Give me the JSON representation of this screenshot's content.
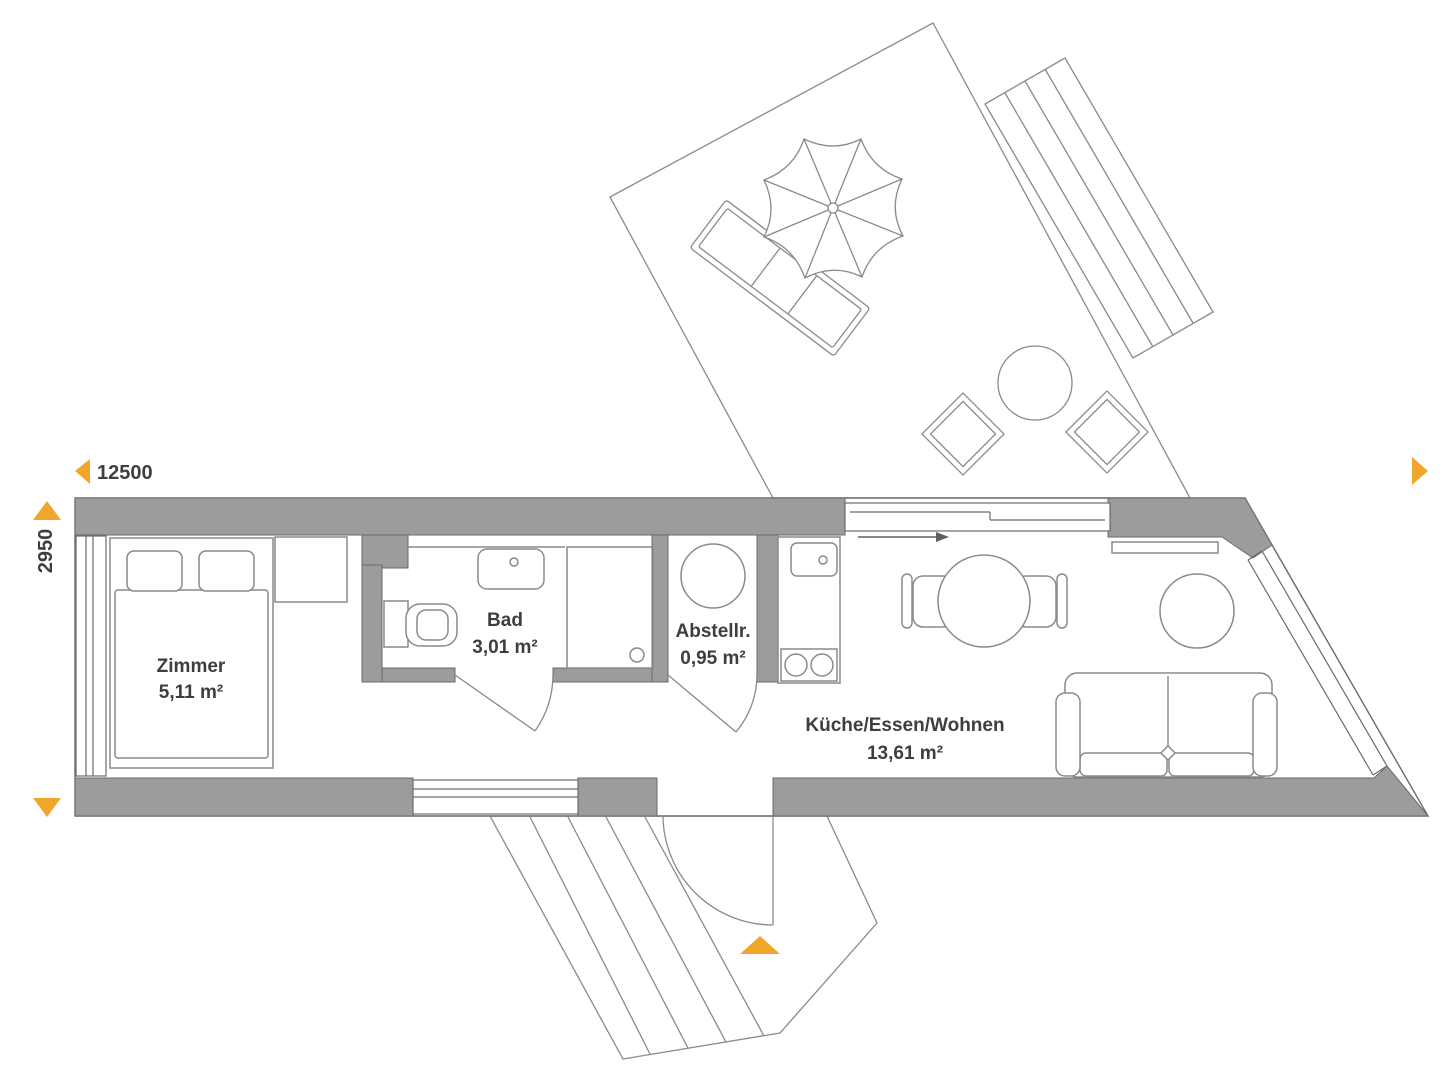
{
  "plan": {
    "title": "floor-plan",
    "dimension_width": {
      "value": "12500",
      "icon": "left-arrow-icon"
    },
    "dimension_height": {
      "value": "2950",
      "icon_top": "up-arrow-icon",
      "icon_bottom": "down-arrow-icon"
    },
    "rooms": [
      {
        "id": "zimmer",
        "name": "Zimmer",
        "area": "5,11 m²"
      },
      {
        "id": "bad",
        "name": "Bad",
        "area": "3,01 m²"
      },
      {
        "id": "abstellraum",
        "name": "Abstellr.",
        "area": "0,95 m²"
      },
      {
        "id": "wohnen",
        "name": "Küche/Essen/Wohnen",
        "area": "13,61 m²"
      }
    ],
    "markers": {
      "entrance": "up-arrow-icon",
      "right_edge": "right-arrow-icon",
      "sliding_door_direction": "right"
    },
    "colors": {
      "accent": "#F2A52B",
      "wall": "#9C9C9C",
      "line": "#6A6A6A",
      "furniture_line": "#8A8A8A",
      "text": "#3E3E3E"
    }
  }
}
